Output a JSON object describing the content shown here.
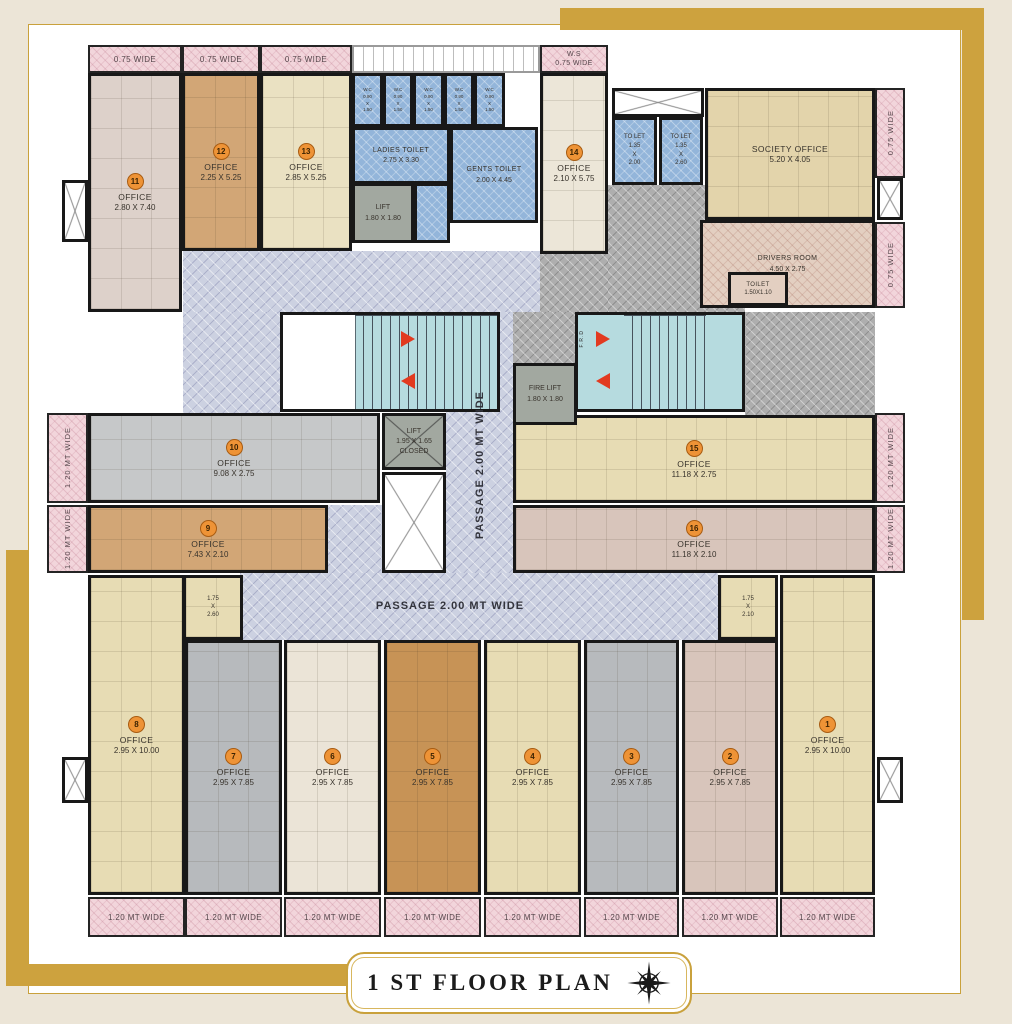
{
  "title": "1 ST  FLOOR PLAN",
  "colors": {
    "gold": "#cda23e",
    "wall": "#181818",
    "badge_orange": "#ee9336",
    "toilet_blue": "#93b5da",
    "stair_teal": "#b6dbdf",
    "passage_lavender": "#ccd1e1",
    "balcony_pink": "#f2d5db"
  },
  "rooms": [
    {
      "name": "office-11",
      "badge": "11",
      "label": "OFFICE",
      "dims": "2.80 X 7.40",
      "cls": "f-mauve grid",
      "x": 88,
      "y": 73,
      "w": 94,
      "h": 239
    },
    {
      "name": "office-12",
      "badge": "12",
      "label": "OFFICE",
      "dims": "2.25 X 5.25",
      "cls": "f-tan grid",
      "x": 182,
      "y": 73,
      "w": 78,
      "h": 178
    },
    {
      "name": "office-13",
      "badge": "13",
      "label": "OFFICE",
      "dims": "2.85 X 5.25",
      "cls": "f-khaki grid",
      "x": 260,
      "y": 73,
      "w": 92,
      "h": 178
    },
    {
      "name": "office-14",
      "badge": "14",
      "label": "OFFICE",
      "dims": "2.10 X 5.75",
      "cls": "f-cream grid",
      "x": 540,
      "y": 73,
      "w": 68,
      "h": 181
    },
    {
      "name": "society-office",
      "label": "SOCIETY OFFICE",
      "dims": "5.20 X 4.05",
      "cls": "f-society grid",
      "x": 705,
      "y": 88,
      "w": 170,
      "h": 132
    },
    {
      "name": "drivers-room",
      "label": "DRIVERS ROOM",
      "dims": "4.50 X 2.75",
      "cls": "f-driver h-pink small",
      "x": 700,
      "y": 220,
      "w": 175,
      "h": 88
    },
    {
      "name": "drivers-toilet",
      "label": "TOILET",
      "dims": "1.50X1.10",
      "cls": "f-driver tiny",
      "x": 728,
      "y": 272,
      "w": 60,
      "h": 34
    },
    {
      "name": "ladies-toilet",
      "label": "LADIES TOILET",
      "dims": "2.75 X 3.30",
      "cls": "f-blue small",
      "x": 352,
      "y": 127,
      "w": 98,
      "h": 57
    },
    {
      "name": "gents-toilet",
      "label": "GENTS TOILET",
      "dims": "2.00 X 4.45",
      "cls": "f-blue small",
      "x": 450,
      "y": 127,
      "w": 88,
      "h": 96
    },
    {
      "name": "wash-area",
      "cls": "f-blue",
      "x": 414,
      "y": 183,
      "w": 36,
      "h": 60
    },
    {
      "name": "wc-1",
      "lines": [
        "W.C",
        "0.90",
        "X",
        "1.50"
      ],
      "cls": "f-blue wc",
      "x": 352,
      "y": 73,
      "w": 31,
      "h": 54
    },
    {
      "name": "wc-2",
      "lines": [
        "W.C",
        "0.90",
        "X",
        "1.50"
      ],
      "cls": "f-blue wc",
      "x": 383,
      "y": 73,
      "w": 30,
      "h": 54
    },
    {
      "name": "wc-3",
      "lines": [
        "W.C",
        "0.90",
        "X",
        "1.50"
      ],
      "cls": "f-blue wc",
      "x": 413,
      "y": 73,
      "w": 31,
      "h": 54
    },
    {
      "name": "wc-4",
      "lines": [
        "W.C",
        "0.90",
        "X",
        "1.50"
      ],
      "cls": "f-blue wc",
      "x": 444,
      "y": 73,
      "w": 30,
      "h": 54
    },
    {
      "name": "wc-5",
      "lines": [
        "W.C",
        "0.90",
        "X",
        "1.50"
      ],
      "cls": "f-blue wc",
      "x": 474,
      "y": 73,
      "w": 31,
      "h": 54
    },
    {
      "name": "tolet-1",
      "lines": [
        "TO LET",
        "1.35",
        "X",
        "2.00"
      ],
      "cls": "f-blue wc2",
      "x": 612,
      "y": 117,
      "w": 45,
      "h": 68
    },
    {
      "name": "tolet-2",
      "lines": [
        "TO LET",
        "1.35",
        "X",
        "2.60"
      ],
      "cls": "f-blue wc2",
      "x": 659,
      "y": 117,
      "w": 44,
      "h": 68
    },
    {
      "name": "lift",
      "lines": [
        "LIFT",
        "1.80 X 1.80"
      ],
      "cls": "f-lift small",
      "x": 352,
      "y": 183,
      "w": 62,
      "h": 60
    },
    {
      "name": "office-10",
      "badge": "10",
      "label": "OFFICE",
      "dims": "9.08 X 2.75",
      "cls": "f-gray2 grid",
      "x": 88,
      "y": 413,
      "w": 292,
      "h": 90
    },
    {
      "name": "office-9",
      "badge": "9",
      "label": "OFFICE",
      "dims": "7.43 X 2.10",
      "cls": "f-tan grid",
      "x": 88,
      "y": 505,
      "w": 240,
      "h": 68
    },
    {
      "name": "office-15",
      "badge": "15",
      "label": "OFFICE",
      "dims": "11.18 X 2.75",
      "cls": "f-beige grid",
      "x": 513,
      "y": 415,
      "w": 362,
      "h": 88
    },
    {
      "name": "office-16",
      "badge": "16",
      "label": "OFFICE",
      "dims": "11.18 X 2.10",
      "cls": "f-pinktan grid",
      "x": 513,
      "y": 505,
      "w": 362,
      "h": 68
    },
    {
      "name": "fire-lift",
      "lines": [
        "FIRE LIFT",
        "1.80 X 1.80"
      ],
      "cls": "f-lift small",
      "x": 513,
      "y": 363,
      "w": 64,
      "h": 62
    },
    {
      "name": "lift-closed",
      "lines": [
        "LIFT",
        "1.95 X 1.65",
        "CLOSED"
      ],
      "cls": "f-lift small xmark",
      "x": 382,
      "y": 413,
      "w": 64,
      "h": 57
    },
    {
      "name": "office-8",
      "badge": "8",
      "label": "OFFICE",
      "dims": "2.95 X 10.00",
      "cls": "f-beige grid",
      "x": 88,
      "y": 575,
      "w": 97,
      "h": 320
    },
    {
      "name": "nook-8",
      "lines": [
        "1.75",
        "X",
        "2.60"
      ],
      "cls": "f-beige tiny grid",
      "x": 183,
      "y": 575,
      "w": 60,
      "h": 65
    },
    {
      "name": "office-7",
      "badge": "7",
      "label": "OFFICE",
      "dims": "2.95 X 7.85",
      "cls": "f-gray grid",
      "x": 185,
      "y": 640,
      "w": 97,
      "h": 255
    },
    {
      "name": "office-6",
      "badge": "6",
      "label": "OFFICE",
      "dims": "2.95 X 7.85",
      "cls": "f-cream2 grid",
      "x": 284,
      "y": 640,
      "w": 97,
      "h": 255
    },
    {
      "name": "office-5",
      "badge": "5",
      "label": "OFFICE",
      "dims": "2.95 X 7.85",
      "cls": "f-orange grid",
      "x": 384,
      "y": 640,
      "w": 97,
      "h": 255
    },
    {
      "name": "office-4",
      "badge": "4",
      "label": "OFFICE",
      "dims": "2.95 X 7.85",
      "cls": "f-beige grid",
      "x": 484,
      "y": 640,
      "w": 97,
      "h": 255
    },
    {
      "name": "office-3",
      "badge": "3",
      "label": "OFFICE",
      "dims": "2.95 X 7.85",
      "cls": "f-gray grid",
      "x": 584,
      "y": 640,
      "w": 95,
      "h": 255
    },
    {
      "name": "office-2",
      "badge": "2",
      "label": "OFFICE",
      "dims": "2.95 X 7.85",
      "cls": "f-pinktan grid",
      "x": 682,
      "y": 640,
      "w": 96,
      "h": 255
    },
    {
      "name": "office-1",
      "badge": "1",
      "label": "OFFICE",
      "dims": "2.95 X 10.00",
      "cls": "f-beige grid",
      "x": 780,
      "y": 575,
      "w": 95,
      "h": 320
    },
    {
      "name": "nook-1",
      "lines": [
        "1.75",
        "X",
        "2.10"
      ],
      "cls": "f-beige tiny grid",
      "x": 718,
      "y": 575,
      "w": 60,
      "h": 65
    }
  ],
  "strips": [
    {
      "name": "balcony-top-1",
      "text": "0.75 WIDE",
      "x": 88,
      "y": 45,
      "w": 94,
      "h": 28
    },
    {
      "name": "balcony-top-2",
      "text": "0.75 WIDE",
      "x": 182,
      "y": 45,
      "w": 78,
      "h": 28
    },
    {
      "name": "balcony-top-3",
      "text": "0.75 WIDE",
      "x": 260,
      "y": 45,
      "w": 92,
      "h": 28
    },
    {
      "name": "balcony-ws",
      "lines": [
        "W.S",
        "0.75 WIDE"
      ],
      "x": 540,
      "y": 45,
      "w": 68,
      "h": 28
    },
    {
      "name": "balcony-right-1",
      "text": "0.75 WIDE",
      "vert": true,
      "x": 875,
      "y": 88,
      "w": 30,
      "h": 90
    },
    {
      "name": "balcony-right-2",
      "text": "0.75 WIDE",
      "vert": true,
      "x": 875,
      "y": 222,
      "w": 30,
      "h": 86
    },
    {
      "name": "balcony-right-3",
      "text": "1.20 MT WIDE",
      "vert": true,
      "x": 875,
      "y": 413,
      "w": 30,
      "h": 90
    },
    {
      "name": "balcony-right-4",
      "text": "1.20 MT WIDE",
      "vert": true,
      "x": 875,
      "y": 505,
      "w": 30,
      "h": 68
    },
    {
      "name": "balcony-left-1",
      "text": "1.20 MT WIDE",
      "vert": true,
      "x": 47,
      "y": 413,
      "w": 41,
      "h": 90
    },
    {
      "name": "balcony-left-2",
      "text": "1.20 MT WIDE",
      "vert": true,
      "x": 47,
      "y": 505,
      "w": 41,
      "h": 68
    },
    {
      "name": "balcony-bottom-1",
      "text": "1.20 MT WIDE",
      "x": 88,
      "y": 897,
      "w": 97,
      "h": 40
    },
    {
      "name": "balcony-bottom-2",
      "text": "1.20 MT WIDE",
      "x": 185,
      "y": 897,
      "w": 97,
      "h": 40
    },
    {
      "name": "balcony-bottom-3",
      "text": "1.20 MT WIDE",
      "x": 284,
      "y": 897,
      "w": 97,
      "h": 40
    },
    {
      "name": "balcony-bottom-4",
      "text": "1.20 MT WIDE",
      "x": 384,
      "y": 897,
      "w": 97,
      "h": 40
    },
    {
      "name": "balcony-bottom-5",
      "text": "1.20 MT WIDE",
      "x": 484,
      "y": 897,
      "w": 97,
      "h": 40
    },
    {
      "name": "balcony-bottom-6",
      "text": "1.20 MT WIDE",
      "x": 584,
      "y": 897,
      "w": 95,
      "h": 40
    },
    {
      "name": "balcony-bottom-7",
      "text": "1.20 MT WIDE",
      "x": 682,
      "y": 897,
      "w": 96,
      "h": 40
    },
    {
      "name": "balcony-bottom-8",
      "text": "1.20 MT WIDE",
      "x": 780,
      "y": 897,
      "w": 95,
      "h": 40
    }
  ],
  "areas": [
    {
      "name": "passage-upper",
      "cls": "lav",
      "x": 183,
      "y": 251,
      "w": 357,
      "h": 61
    },
    {
      "name": "passage-left",
      "cls": "lav",
      "x": 183,
      "y": 312,
      "w": 97,
      "h": 101
    },
    {
      "name": "passage-vertical",
      "cls": "lav",
      "x": 446,
      "y": 312,
      "w": 67,
      "h": 303
    },
    {
      "name": "passage-lower",
      "cls": "lav",
      "x": 240,
      "y": 573,
      "w": 478,
      "h": 67
    },
    {
      "name": "passage-mid",
      "cls": "lav",
      "x": 328,
      "y": 505,
      "w": 118,
      "h": 68
    },
    {
      "name": "lobby-hatch-1",
      "cls": "ghatch",
      "x": 608,
      "y": 185,
      "w": 137,
      "h": 127
    },
    {
      "name": "lobby-hatch-2",
      "cls": "ghatch",
      "x": 540,
      "y": 254,
      "w": 68,
      "h": 58
    },
    {
      "name": "lobby-hatch-3",
      "cls": "ghatch",
      "x": 513,
      "y": 312,
      "w": 62,
      "h": 51
    },
    {
      "name": "lobby-hatch-4",
      "cls": "ghatch",
      "x": 745,
      "y": 312,
      "w": 130,
      "h": 103
    }
  ],
  "ducts": [
    {
      "name": "duct-tolet",
      "cls": "duct",
      "x": 612,
      "y": 88,
      "w": 92,
      "h": 29
    },
    {
      "name": "duct-right-top",
      "cls": "duct",
      "x": 877,
      "y": 178,
      "w": 26,
      "h": 42
    },
    {
      "name": "duct-left-top",
      "cls": "duct",
      "x": 62,
      "y": 180,
      "w": 26,
      "h": 62
    },
    {
      "name": "duct-left-bottom",
      "cls": "duct",
      "x": 62,
      "y": 757,
      "w": 26,
      "h": 46
    },
    {
      "name": "duct-right-bottom",
      "cls": "duct",
      "x": 877,
      "y": 757,
      "w": 26,
      "h": 46
    },
    {
      "name": "duct-core",
      "cls": "duct",
      "x": 382,
      "y": 472,
      "w": 64,
      "h": 101
    },
    {
      "name": "open-strip",
      "cls": "wstrip",
      "x": 352,
      "y": 45,
      "w": 188,
      "h": 28
    }
  ],
  "stairs": [
    {
      "name": "staircase-left",
      "x": 280,
      "y": 312,
      "w": 220,
      "h": 100,
      "landing": 72,
      "treadL": 72,
      "treadW": 142,
      "arrowX": 118
    },
    {
      "name": "staircase-right",
      "x": 575,
      "y": 312,
      "w": 170,
      "h": 100,
      "landing": 0,
      "treadL": 46,
      "treadW": 82,
      "arrowX": 18
    }
  ],
  "labels": [
    {
      "name": "passage-label-vertical",
      "text": "PASSAGE 2.00 MT WIDE",
      "vert": true,
      "cls": "passage",
      "x": 462,
      "y": 330,
      "w": 36,
      "h": 270
    },
    {
      "name": "passage-label-horizontal",
      "text": "PASSAGE 2.00  MT WIDE",
      "cls": "passage",
      "x": 350,
      "y": 596,
      "w": 200,
      "h": 20
    },
    {
      "name": "frd-label",
      "text": "F.R.D",
      "vert": true,
      "cls": "frd",
      "x": 576,
      "y": 316,
      "w": 12,
      "h": 46
    }
  ]
}
